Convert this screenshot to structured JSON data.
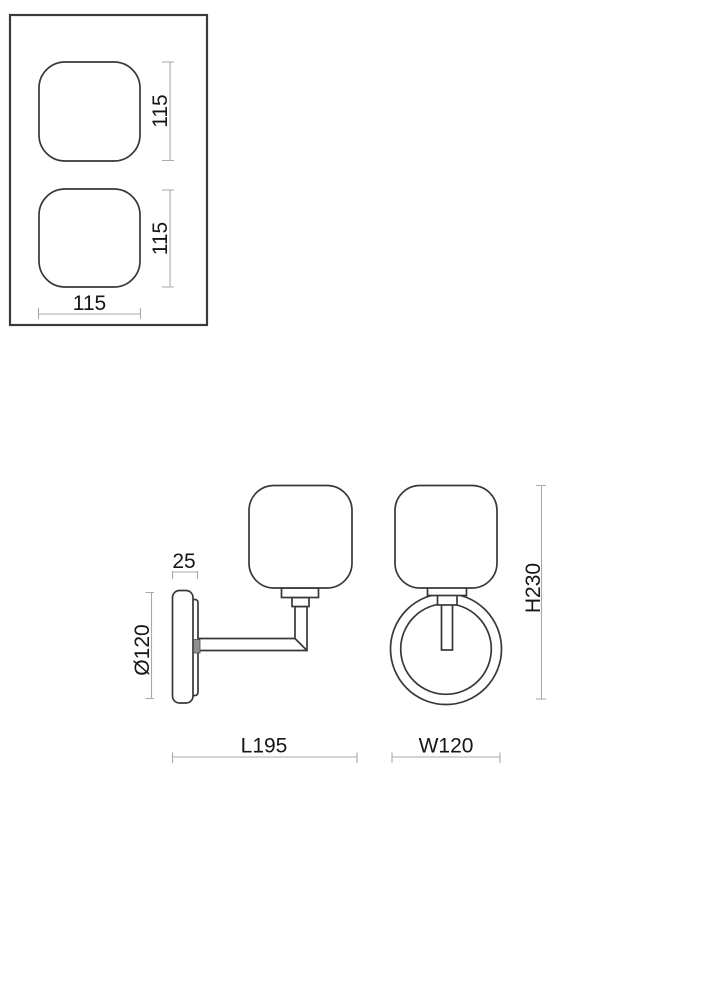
{
  "mounting_template": {
    "dim_top_square_height": "115",
    "dim_bottom_square_height": "115",
    "dim_square_width": "115"
  },
  "side_view": {
    "dim_backplate_depth": "25",
    "dim_backplate_diameter": "Ø120",
    "dim_projection_length": "L195"
  },
  "front_view": {
    "dim_overall_height": "H230",
    "dim_overall_width": "W120"
  },
  "colors": {
    "background": "#ffffff",
    "outline": "#383838",
    "dimension_line": "#a9a9a9",
    "text": "#161616",
    "joint_fill": "#8f8f8f"
  }
}
